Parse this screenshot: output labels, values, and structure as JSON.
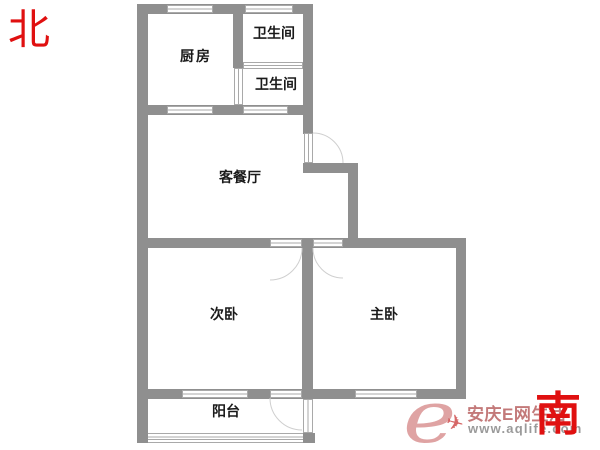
{
  "title": "两室一厅户型图",
  "compass": {
    "north_label": "北",
    "south_label": "南"
  },
  "rooms": {
    "kitchen": "厨房",
    "bath_top": "卫生间",
    "bath_bottom": "卫生间",
    "living_dining": "客餐厅",
    "second_bedroom": "次卧",
    "master_bedroom": "主卧",
    "balcony": "阳台"
  },
  "watermark": {
    "logo_letter": "e",
    "site_name": "安庆E网生活",
    "site_url": "www.aqlife.com",
    "plane_icon": "✈"
  },
  "colors": {
    "wall": "#8f8f8f",
    "win_border": "#a9a9a9",
    "arc": "#cfcfcf",
    "label": "#1a1a1a",
    "compass_red": "#e01010",
    "wm_text": "#b96262",
    "wm_url": "#9a9a9a",
    "wm_logo": "#dc9a9a",
    "wm_plane": "#cc4343"
  }
}
